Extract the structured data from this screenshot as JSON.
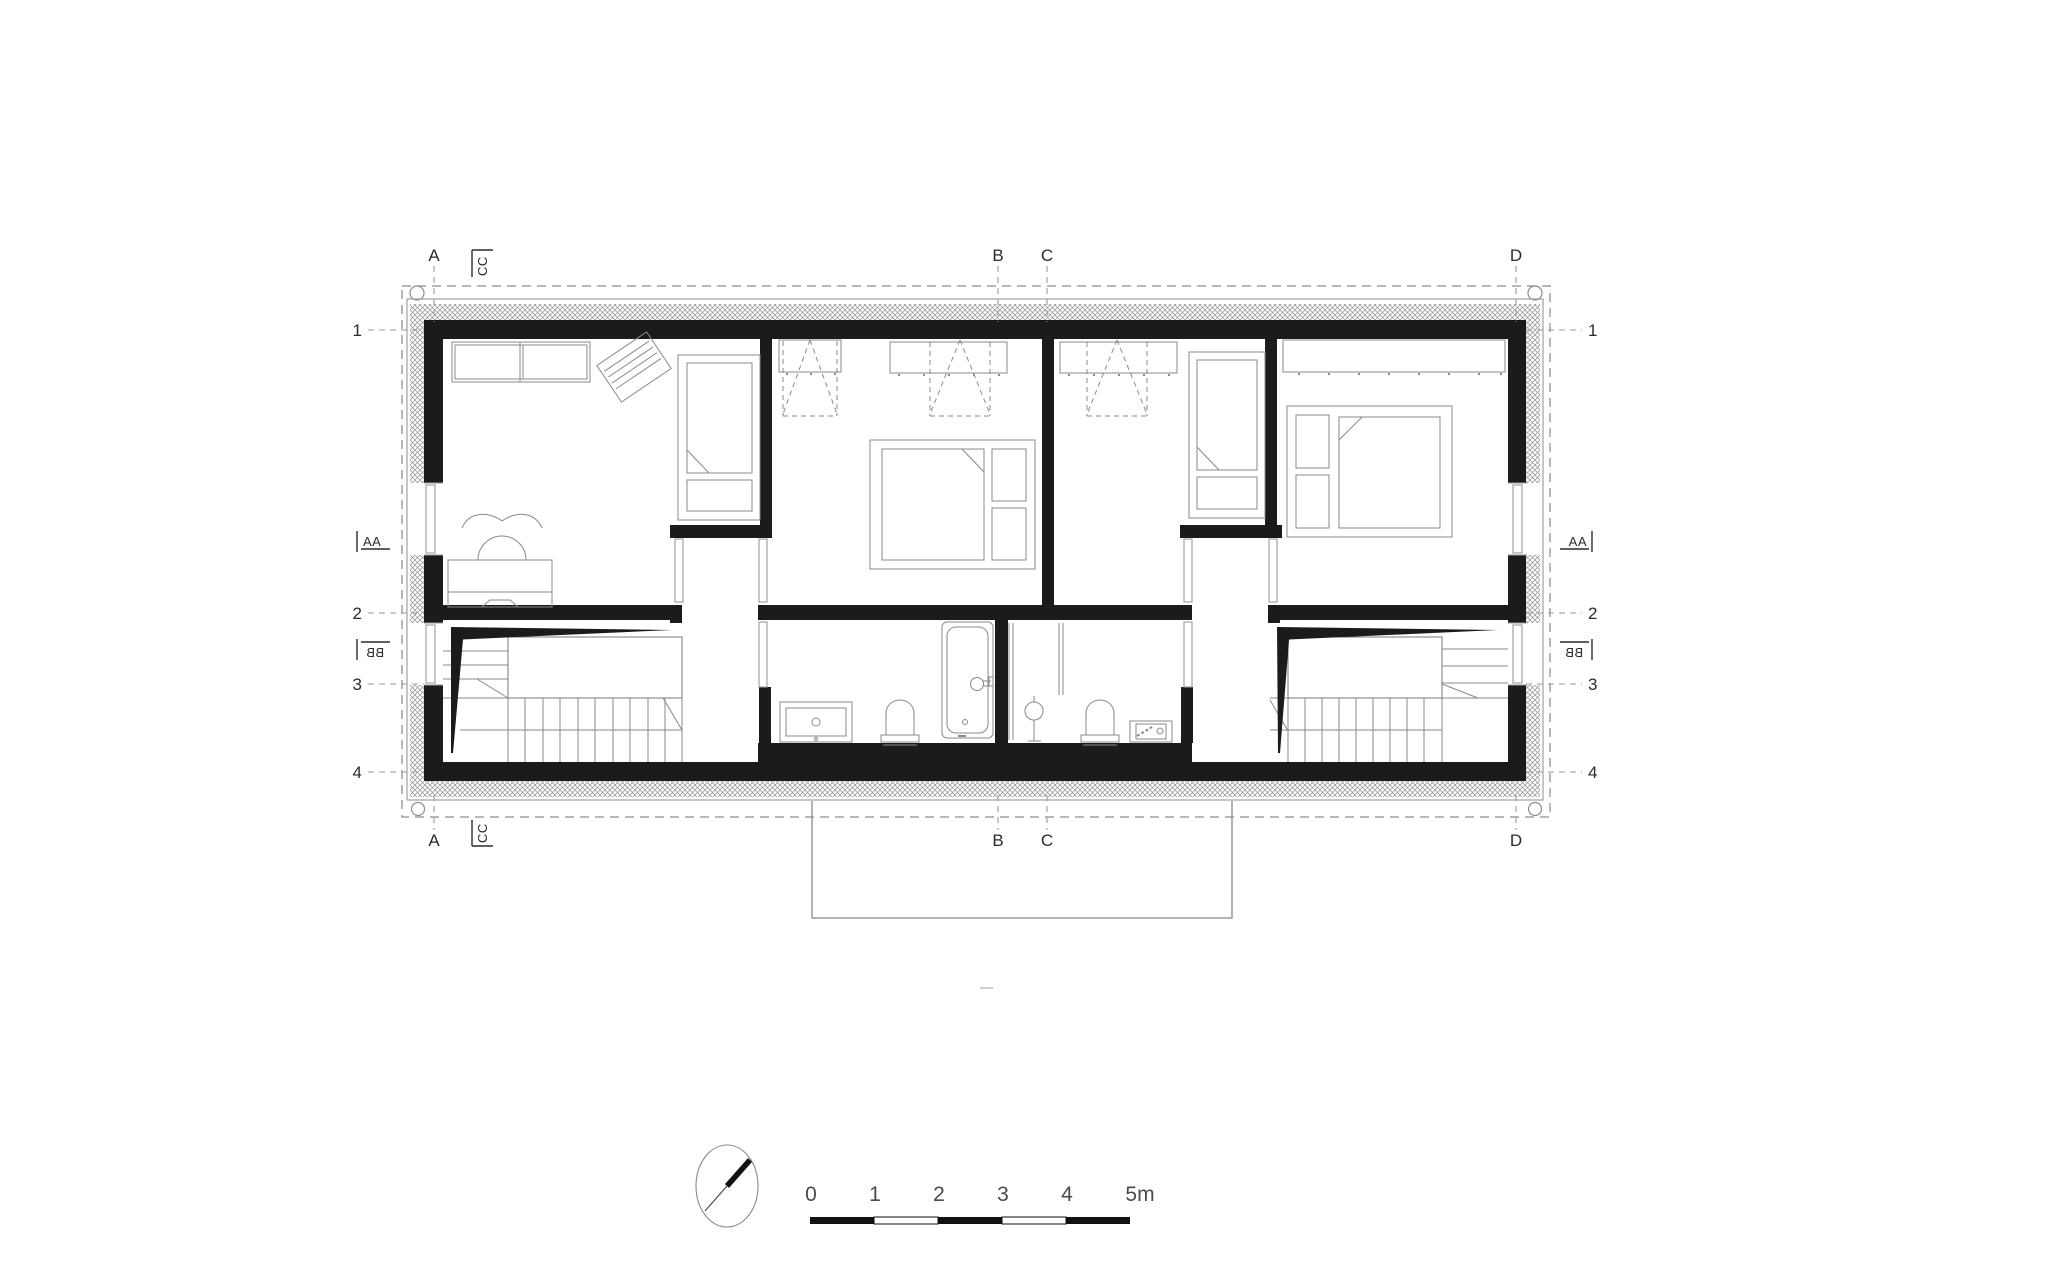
{
  "plan": {
    "title": "attic floor plan",
    "grid": {
      "columns": [
        "A",
        "B",
        "C",
        "D"
      ],
      "rows": [
        "1",
        "2",
        "3",
        "4"
      ]
    },
    "section_markers": {
      "aa": "AA",
      "bb": "BB",
      "cc": "CC"
    },
    "scale_bar": {
      "ticks": [
        "0",
        "1",
        "2",
        "3",
        "4",
        "5m"
      ]
    },
    "colors": {
      "wall": "#1b1b1b",
      "furniture_line": "#8a8a8a",
      "boundary_line": "#999999",
      "label_text": "#2b2b2b",
      "scale_text": "#4a4a4a"
    }
  }
}
